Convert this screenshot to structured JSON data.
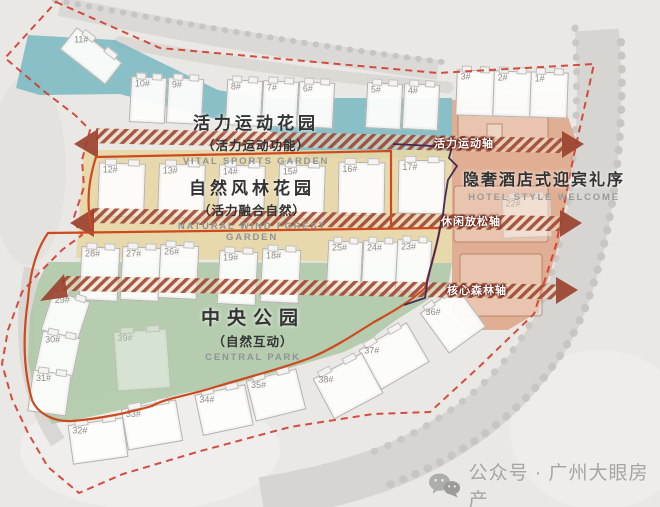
{
  "plan_title": "residential-master-plan",
  "zones": {
    "vital_sports": {
      "title": "活力运动花园",
      "subtitle": "（活力运动功能）",
      "en": "VITAL SPORTS GARDEN",
      "color": "#74b6c0"
    },
    "forest_garden": {
      "title": "自然风林花园",
      "subtitle": "（活力融合自然）",
      "en": "NATURAL WIND FOREST GARDEN",
      "color": "#e8d7a6"
    },
    "central_park": {
      "title": "中央公园",
      "subtitle": "（自然互动）",
      "en": "CENTRAL PARK",
      "color": "#afc9a9"
    },
    "hotel_welcome": {
      "title": "隐奢酒店式迎宾礼序",
      "en": "HOTEL STYLE WELCOME",
      "color": "#dd9f7e"
    }
  },
  "axes": [
    {
      "label": "活力运动轴"
    },
    {
      "label": "休闲放松轴"
    },
    {
      "label": "核心森林轴"
    }
  ],
  "boundary": {
    "color": "#d23b2e",
    "style": "dashed"
  },
  "paths": {
    "loop_color": "#cd4a1e",
    "route_color": "#472a55",
    "band_color": "#9c4330"
  },
  "watermark": {
    "icon": "wechat-icon",
    "text": "公众号 · 广州大眼房产"
  },
  "buildings": {
    "items": [
      {
        "label": "11#"
      },
      {
        "label": "10#"
      },
      {
        "label": "9#"
      },
      {
        "label": "8#"
      },
      {
        "label": "7#"
      },
      {
        "label": "6#"
      },
      {
        "label": "5#"
      },
      {
        "label": "4#"
      },
      {
        "label": "3#"
      },
      {
        "label": "2#"
      },
      {
        "label": "1#"
      },
      {
        "label": "12#"
      },
      {
        "label": "13#"
      },
      {
        "label": "14#"
      },
      {
        "label": "15#"
      },
      {
        "label": "16#"
      },
      {
        "label": "17#"
      },
      {
        "label": "28#"
      },
      {
        "label": "27#"
      },
      {
        "label": "26#"
      },
      {
        "label": "19#"
      },
      {
        "label": "18#"
      },
      {
        "label": "25#"
      },
      {
        "label": "24#"
      },
      {
        "label": "23#"
      },
      {
        "label": "22#"
      },
      {
        "label": "29#"
      },
      {
        "label": "30#"
      },
      {
        "label": "31#"
      },
      {
        "label": "32#"
      },
      {
        "label": "33#"
      },
      {
        "label": "34#"
      },
      {
        "label": "35#"
      },
      {
        "label": "36#"
      },
      {
        "label": "37#"
      },
      {
        "label": "38#"
      },
      {
        "label": "39#"
      }
    ]
  }
}
